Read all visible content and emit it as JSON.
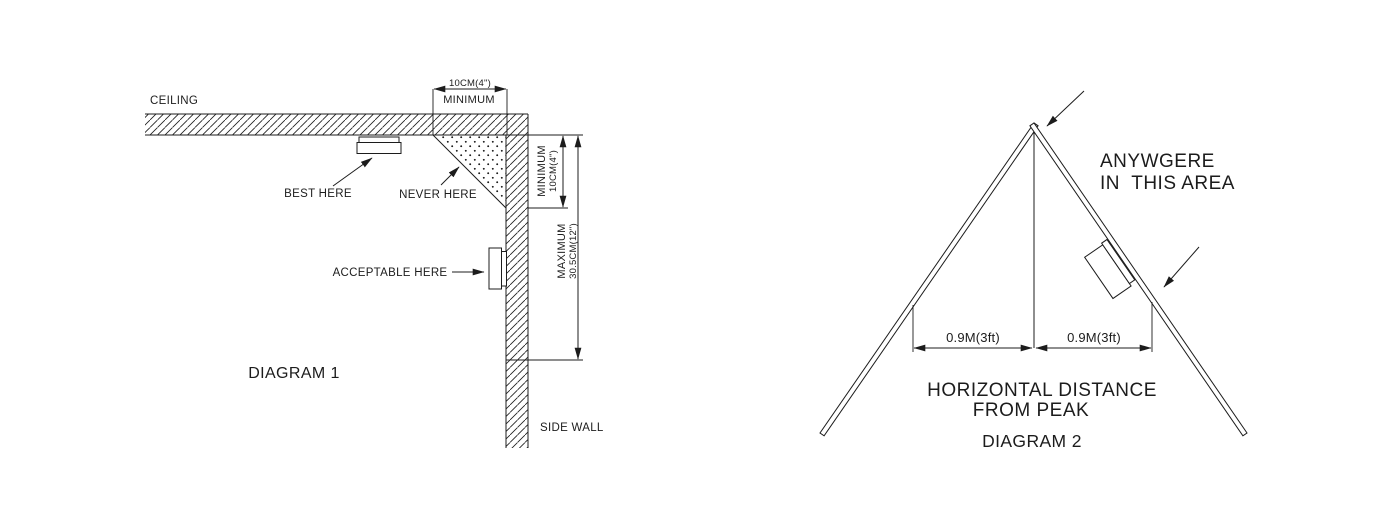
{
  "page": {
    "background_color": "#ffffff",
    "ink_color": "#1c1c1c"
  },
  "diagram1": {
    "title": "DIAGRAM 1",
    "ceiling_label": "CEILING",
    "side_wall_label": "SIDE WALL",
    "best_here_label": "BEST HERE",
    "never_here_label": "NEVER HERE",
    "acceptable_here_label": "ACCEPTABLE HERE",
    "top_dimension_value": "10CM(4\")",
    "top_dimension_caption": "MINIMUM",
    "corner_dimension_caption": "MINIMUM",
    "corner_dimension_value": "10CM(4\")",
    "wall_dimension_caption": "MAXIMUM",
    "wall_dimension_value": "30.5CM(12\")"
  },
  "diagram2": {
    "title": "DIAGRAM 2",
    "area_note_line1": "ANYWGERE",
    "area_note_line2": "IN  THIS AREA",
    "left_distance_value": "0.9M(3ft)",
    "right_distance_value": "0.9M(3ft)",
    "caption_line1": "HORIZONTAL DISTANCE",
    "caption_line2": "FROM PEAK"
  }
}
